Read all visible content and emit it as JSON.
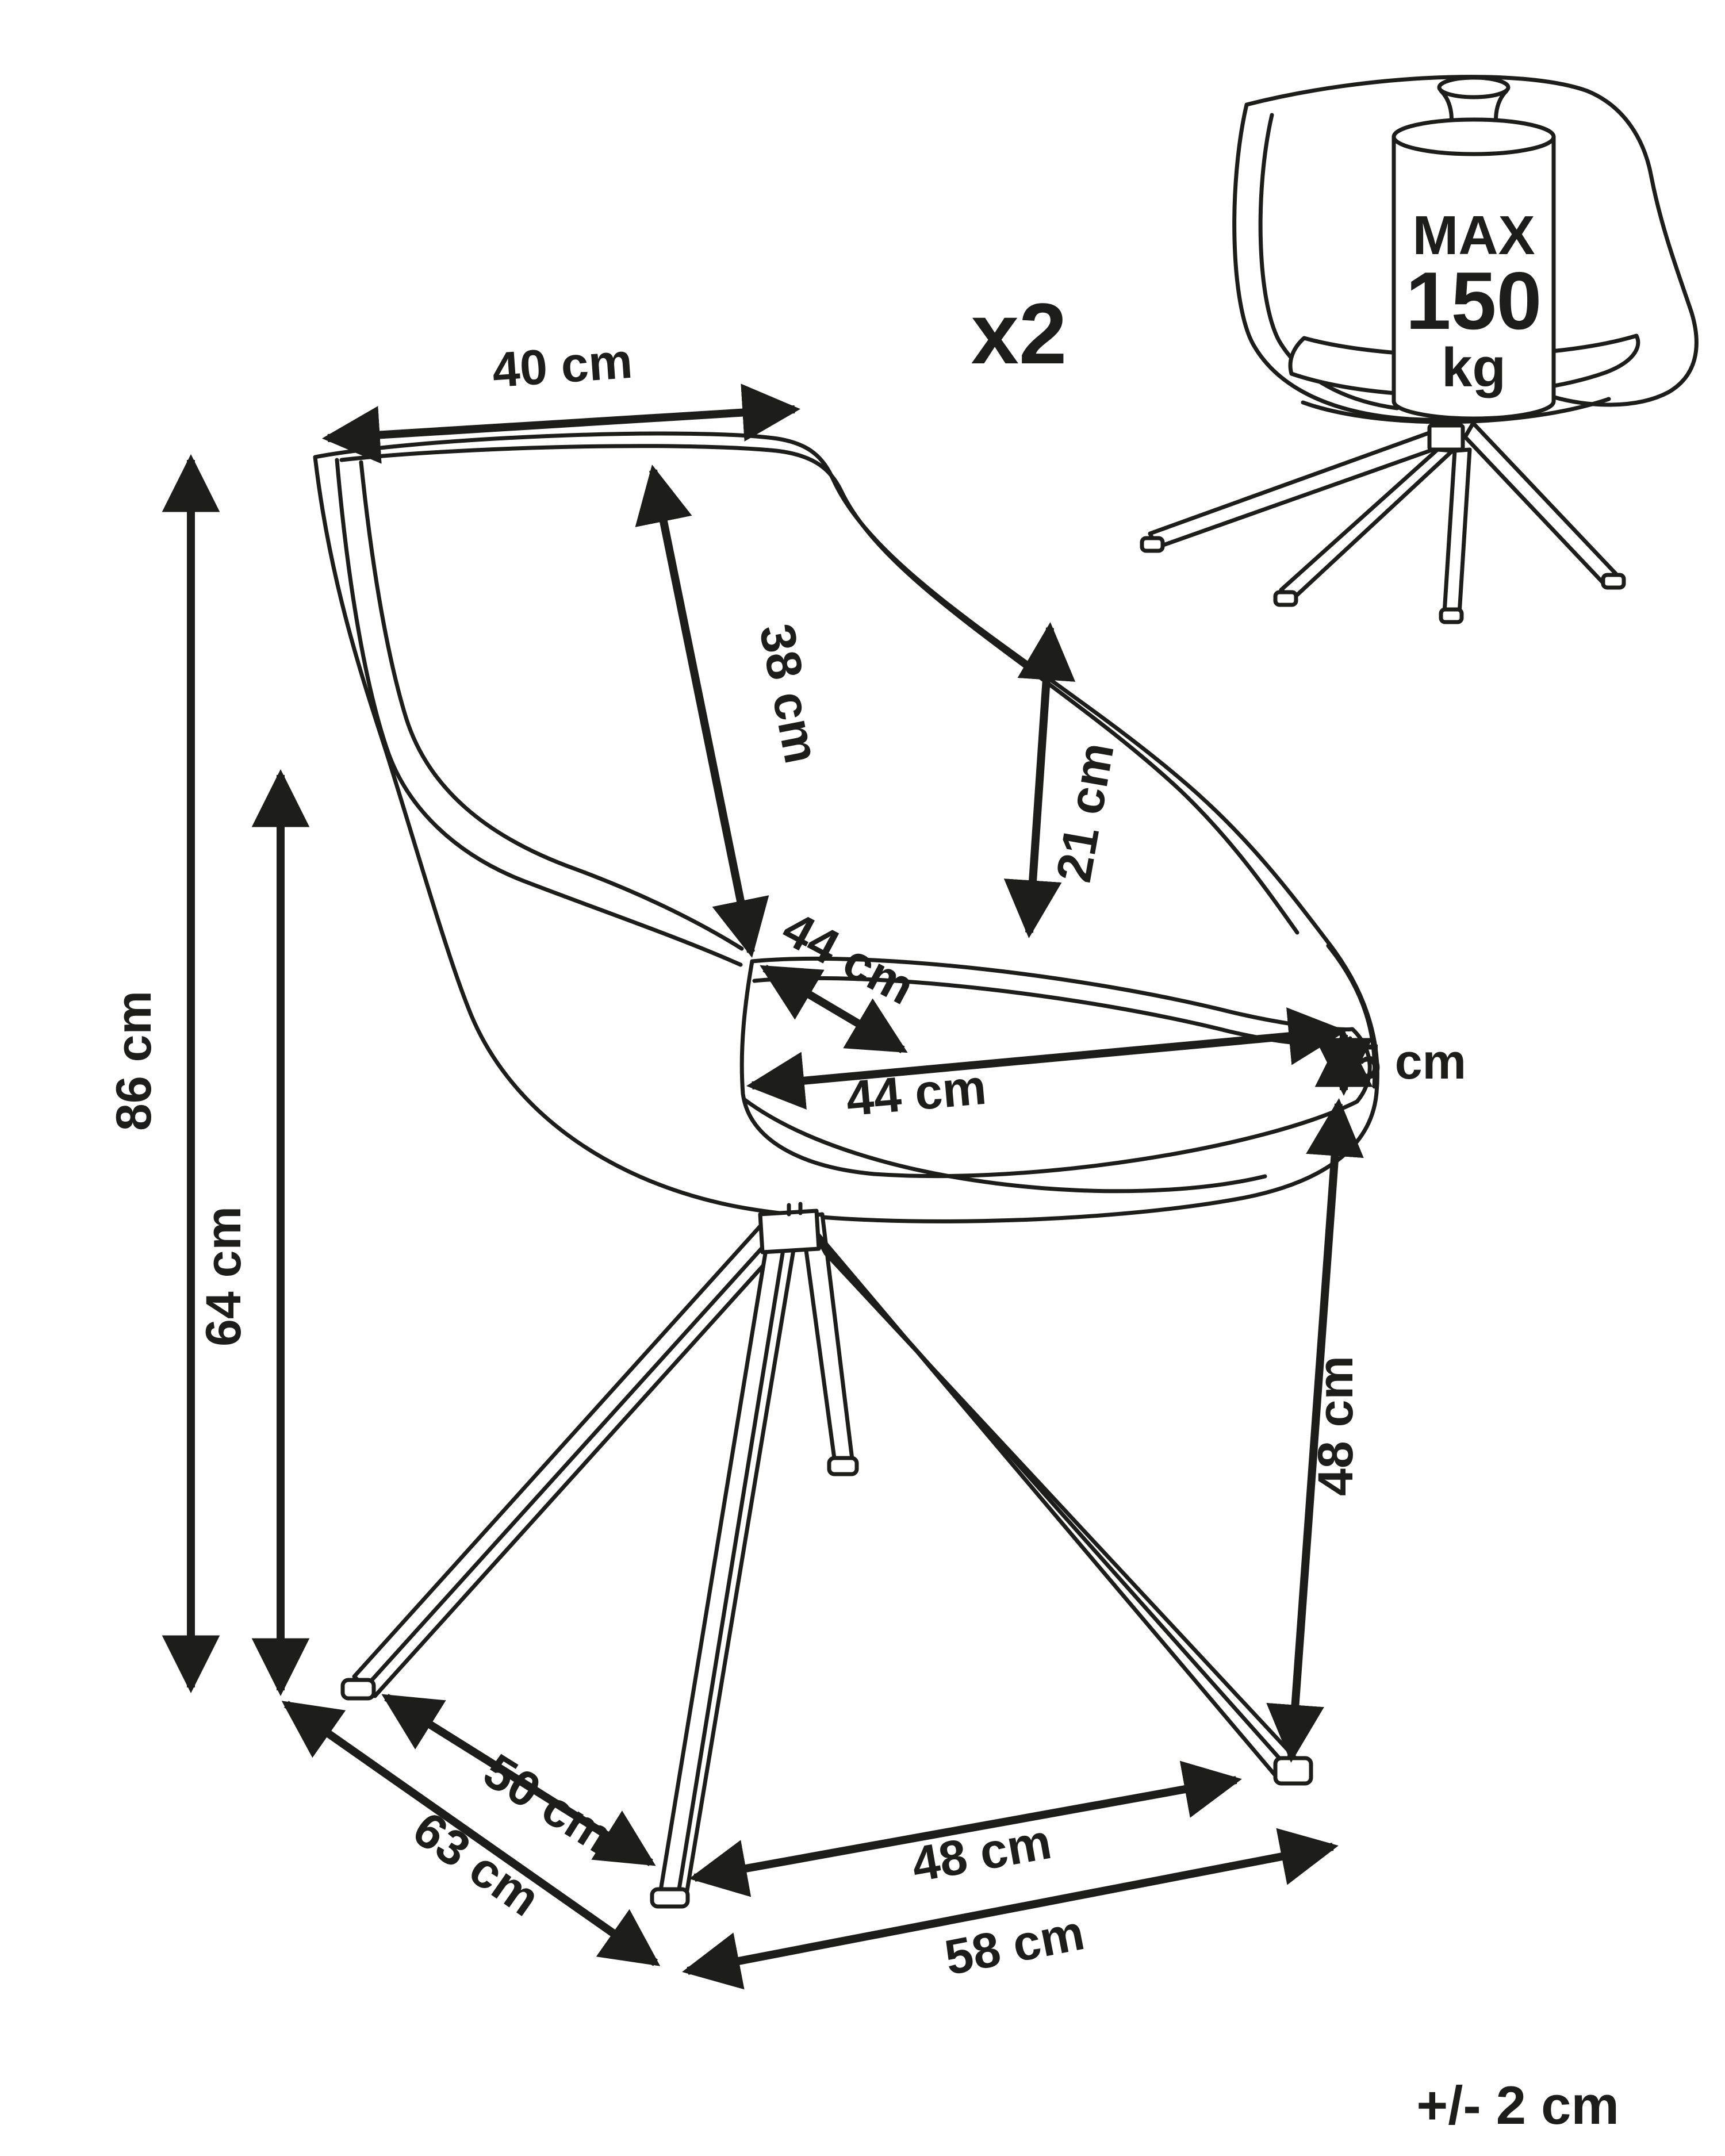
{
  "page": {
    "background": "#ffffff",
    "line_color": "#1d1d1b"
  },
  "quantity_label": "x2",
  "tolerance_note": "+/- 2 cm",
  "weight_capacity": {
    "line1": "MAX",
    "line2": "150",
    "line3": "kg"
  },
  "dimensions": {
    "backrest_width": "40 cm",
    "backrest_height": "38 cm",
    "armrest_length": "21 cm",
    "seat_depth": "44 cm",
    "seat_width": "44 cm",
    "cushion_thickness": "5 cm",
    "total_height": "86 cm",
    "armrest_floor_height": "64 cm",
    "seat_height": "48 cm",
    "base_span_inner_front": "48 cm",
    "base_span_inner_left": "50 cm",
    "base_span_outer_left": "63 cm",
    "base_span_outer_front": "58 cm"
  }
}
